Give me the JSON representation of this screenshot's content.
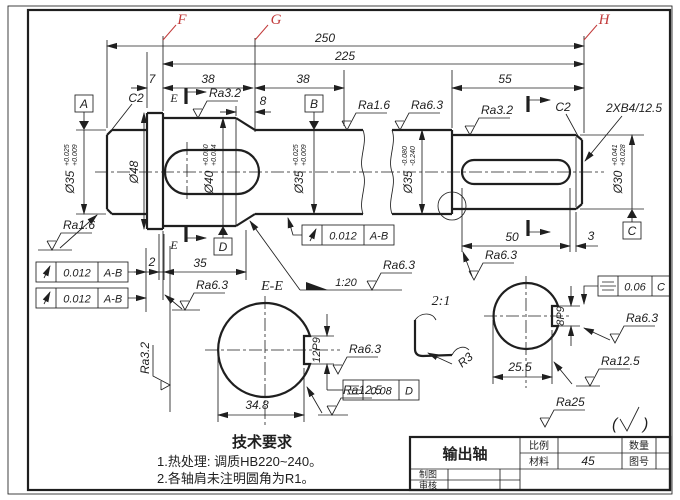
{
  "colors": {
    "ink": "#1f1f1f",
    "red": "#c23b3b",
    "paper": "#ffffff"
  },
  "labels": {
    "f": "F",
    "g": "G",
    "h": "H",
    "e_top": "E",
    "e_bot": "E",
    "section": "E-E",
    "detail_scale": "2:1",
    "taper": "1:20",
    "fillet": "R3"
  },
  "datums": {
    "a": "A",
    "b": "B",
    "c": "C",
    "d": "D"
  },
  "dims": {
    "overall": "250",
    "sub": "225",
    "w7": "7",
    "w38a": "38",
    "w38b": "38",
    "w55": "55",
    "w8": "8",
    "w2": "2",
    "w35": "35",
    "w50": "50",
    "w3": "3",
    "ee_width": "34.8",
    "ee_key": "12P9",
    "rs_width": "25.5",
    "rs_key": "8P9",
    "chamfer_left": "C2",
    "chamfer_right": "C2",
    "center_holes": "2XB4/12.5"
  },
  "dia": {
    "d35l": {
      "v": "Ø35",
      "u": "+0.025",
      "l": "+0.009"
    },
    "d48": {
      "v": "Ø48"
    },
    "d40": {
      "v": "Ø40",
      "u": "+0.050",
      "l": "+0.034"
    },
    "d35m": {
      "v": "Ø35",
      "u": "+0.025",
      "l": "+0.009"
    },
    "d35r": {
      "v": "Ø35",
      "u": "-0.080",
      "l": "-0.240"
    },
    "d30": {
      "v": "Ø30",
      "u": "+0.041",
      "l": "+0.028"
    }
  },
  "ra": {
    "taper_top": "Ra3.2",
    "mid_top": "Ra1.6",
    "seal_top": "Ra6.3",
    "d30_top": "Ra3.2",
    "left_journal": "Ra1.6",
    "left_face": "Ra3.2",
    "collar_face": "Ra6.3",
    "taper_surface": "Ra6.3",
    "slot": "Ra6.3",
    "ee_side": "Ra6.3",
    "ee_flat": "Ra12.5",
    "rs_side": "Ra6.3",
    "rs_flat": "Ra12.5",
    "end": "Ra25",
    "rest_open": "(",
    "rest_close": ")"
  },
  "frames": {
    "r1": {
      "val": "0.012",
      "ref": "A-B"
    },
    "r2": {
      "val": "0.012",
      "ref": "A-B"
    },
    "r3": {
      "val": "0.012",
      "ref": "A-B"
    },
    "s1": {
      "val": "0.08",
      "ref": "D"
    },
    "s2": {
      "val": "0.06",
      "ref": "C"
    }
  },
  "tech": {
    "title": "技术要求",
    "line1": "1.热处理: 调质HB220~240。",
    "line2": "2.各轴肩未注明圆角为R1。"
  },
  "title_block": {
    "part": "输出轴",
    "scale_label": "比例",
    "material_label": "材料",
    "material": "45",
    "qty_label": "数量",
    "dwg_label": "图号",
    "drawn_label": "制图",
    "check_label": "审核"
  }
}
